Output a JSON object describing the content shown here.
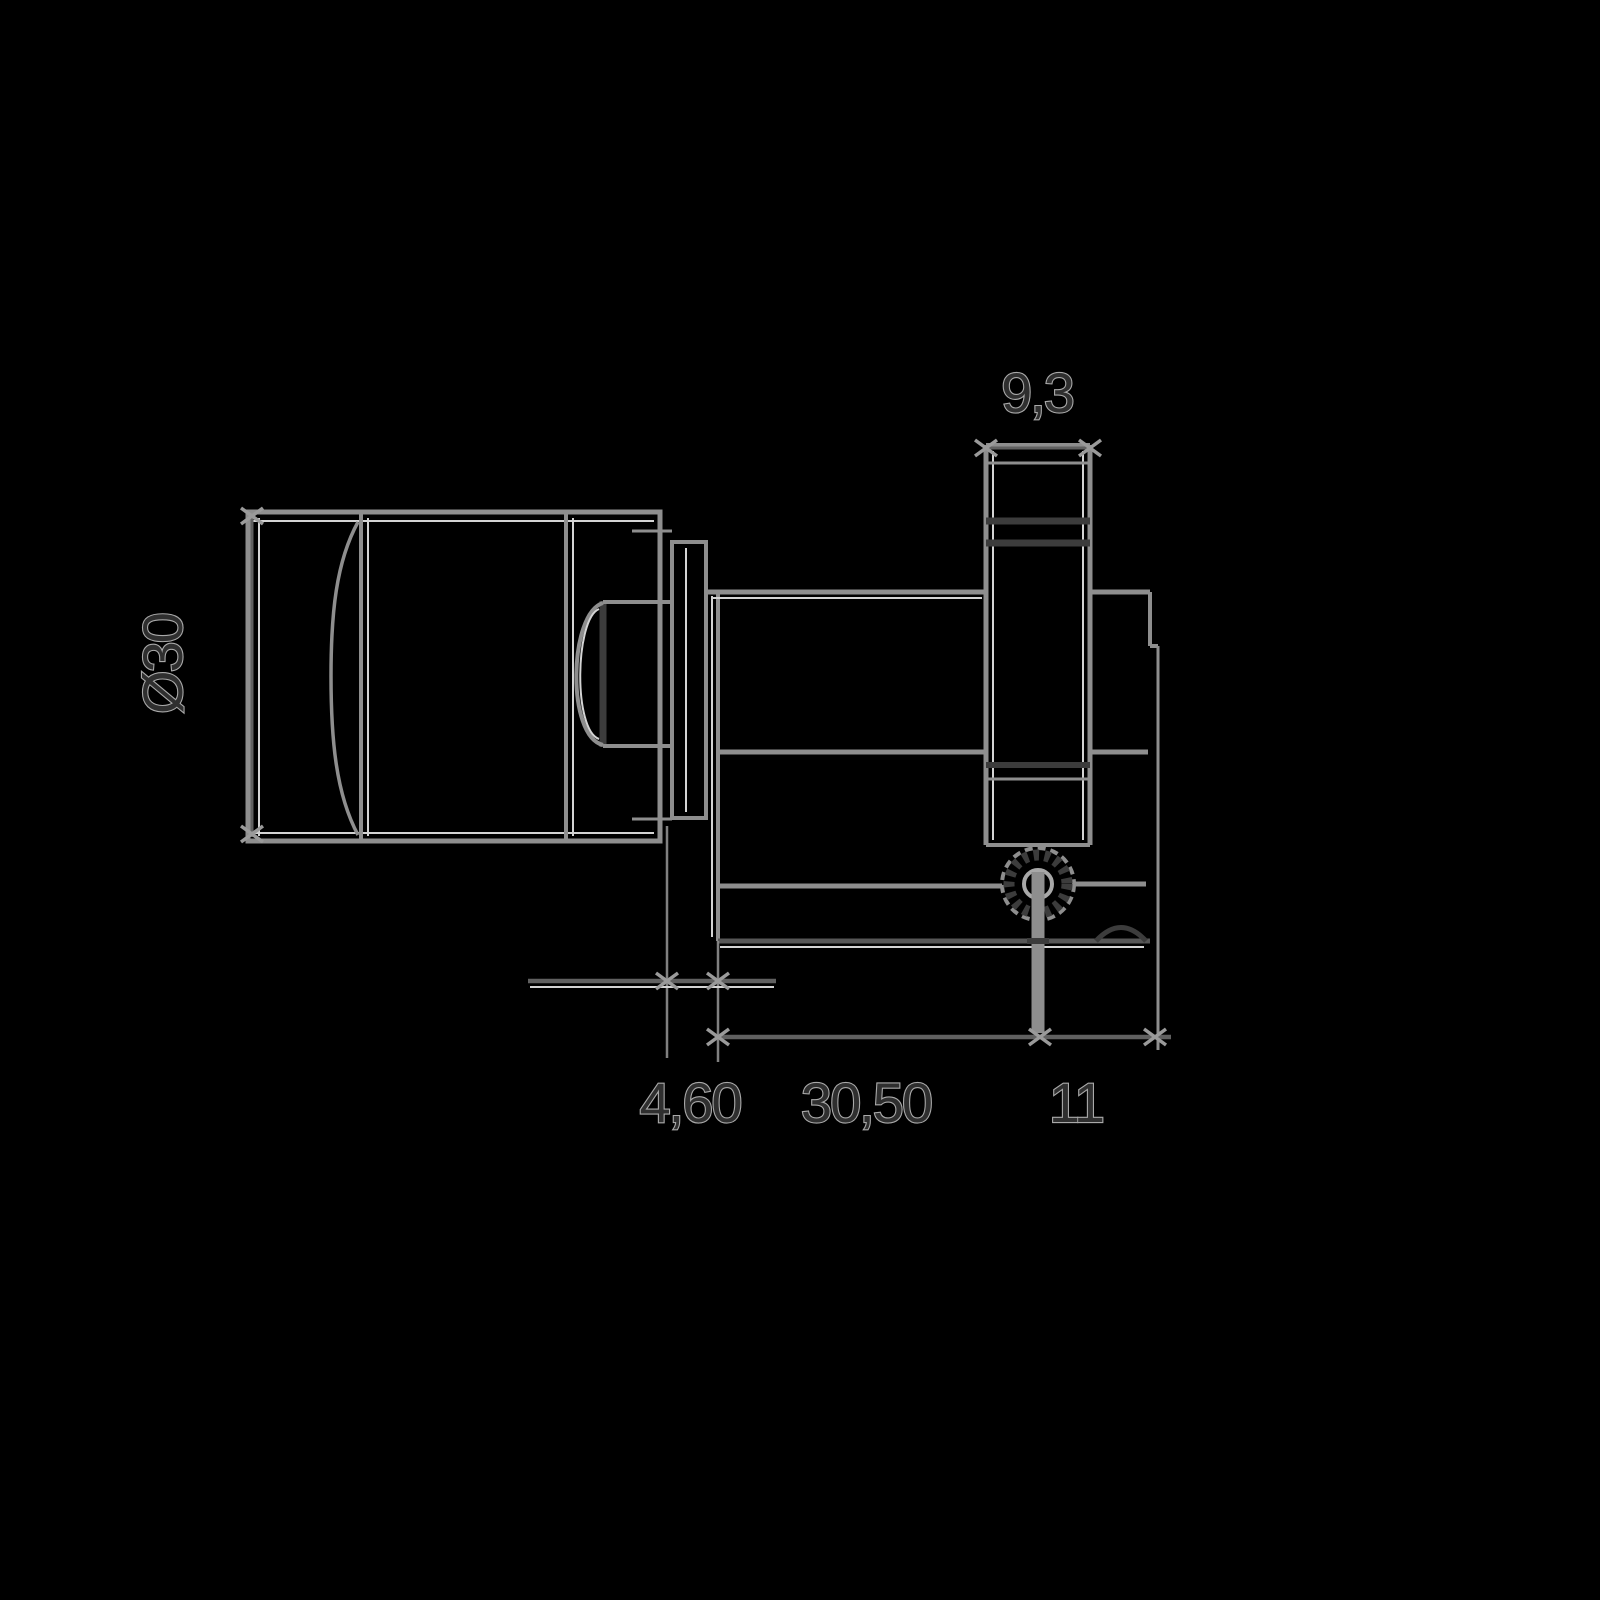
{
  "canvas": {
    "width": 1600,
    "height": 1600,
    "colors": {
      "background": "#000000",
      "line": "#8e8e8e",
      "line-light": "#a8a8a8",
      "dark": "#3c3c3c",
      "highlight": "#d4d4d4",
      "dim": "#606060",
      "arrow": "#9a9a9a",
      "text-fill": "#2f2f2f",
      "text-outline": "#a9a9a9"
    }
  },
  "drawing": {
    "type": "dimensioned technical line drawing",
    "dimensions": {
      "knob_diameter": {
        "label": "Ø30"
      },
      "cam_width": {
        "label": "9,3"
      },
      "flange_thickness": {
        "label": "4,60"
      },
      "body_length": {
        "label": "30,50"
      },
      "rear_offset": {
        "label": "11"
      }
    }
  }
}
